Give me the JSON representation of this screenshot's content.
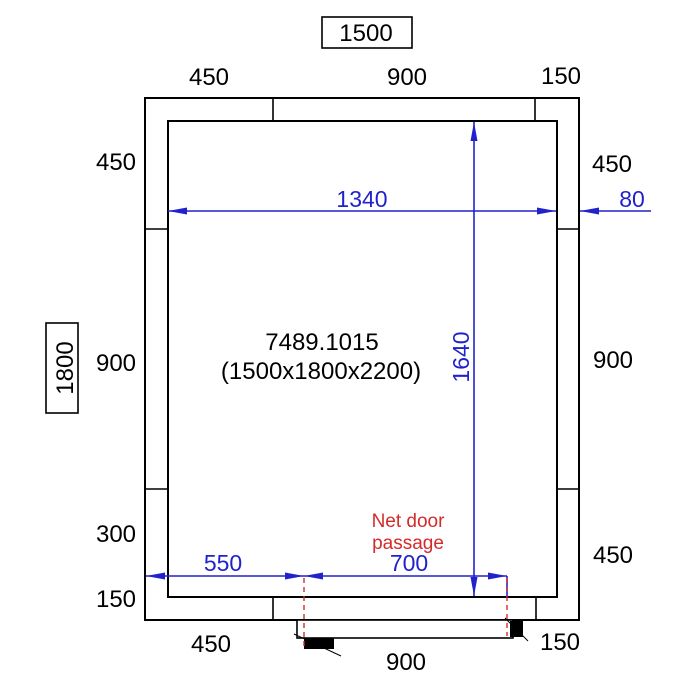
{
  "product": {
    "code": "7489.1015",
    "size_label": "(1500x1800x2200)"
  },
  "overall": {
    "width": "1500",
    "depth": "1800"
  },
  "dims_top": {
    "left": "450",
    "middle": "900",
    "right": "150"
  },
  "dims_left": {
    "seg1": "450",
    "seg2": "900",
    "seg3": "300",
    "seg4": "150"
  },
  "dims_right": {
    "seg1": "450",
    "seg2": "900",
    "seg3": "450"
  },
  "dims_bottom": {
    "left": "450",
    "middle": "900",
    "right": "150"
  },
  "dims_blue": {
    "inner_width": "1340",
    "inner_depth": "1640",
    "wall_thickness": "80",
    "door_offset": "550",
    "door_passage": "700"
  },
  "door_note": {
    "line1": "Net door",
    "line2": "passage"
  },
  "colors": {
    "outline": "#000000",
    "dimension_blue": "#2222cc",
    "annotation_red": "#d42a2a",
    "background": "#ffffff"
  }
}
